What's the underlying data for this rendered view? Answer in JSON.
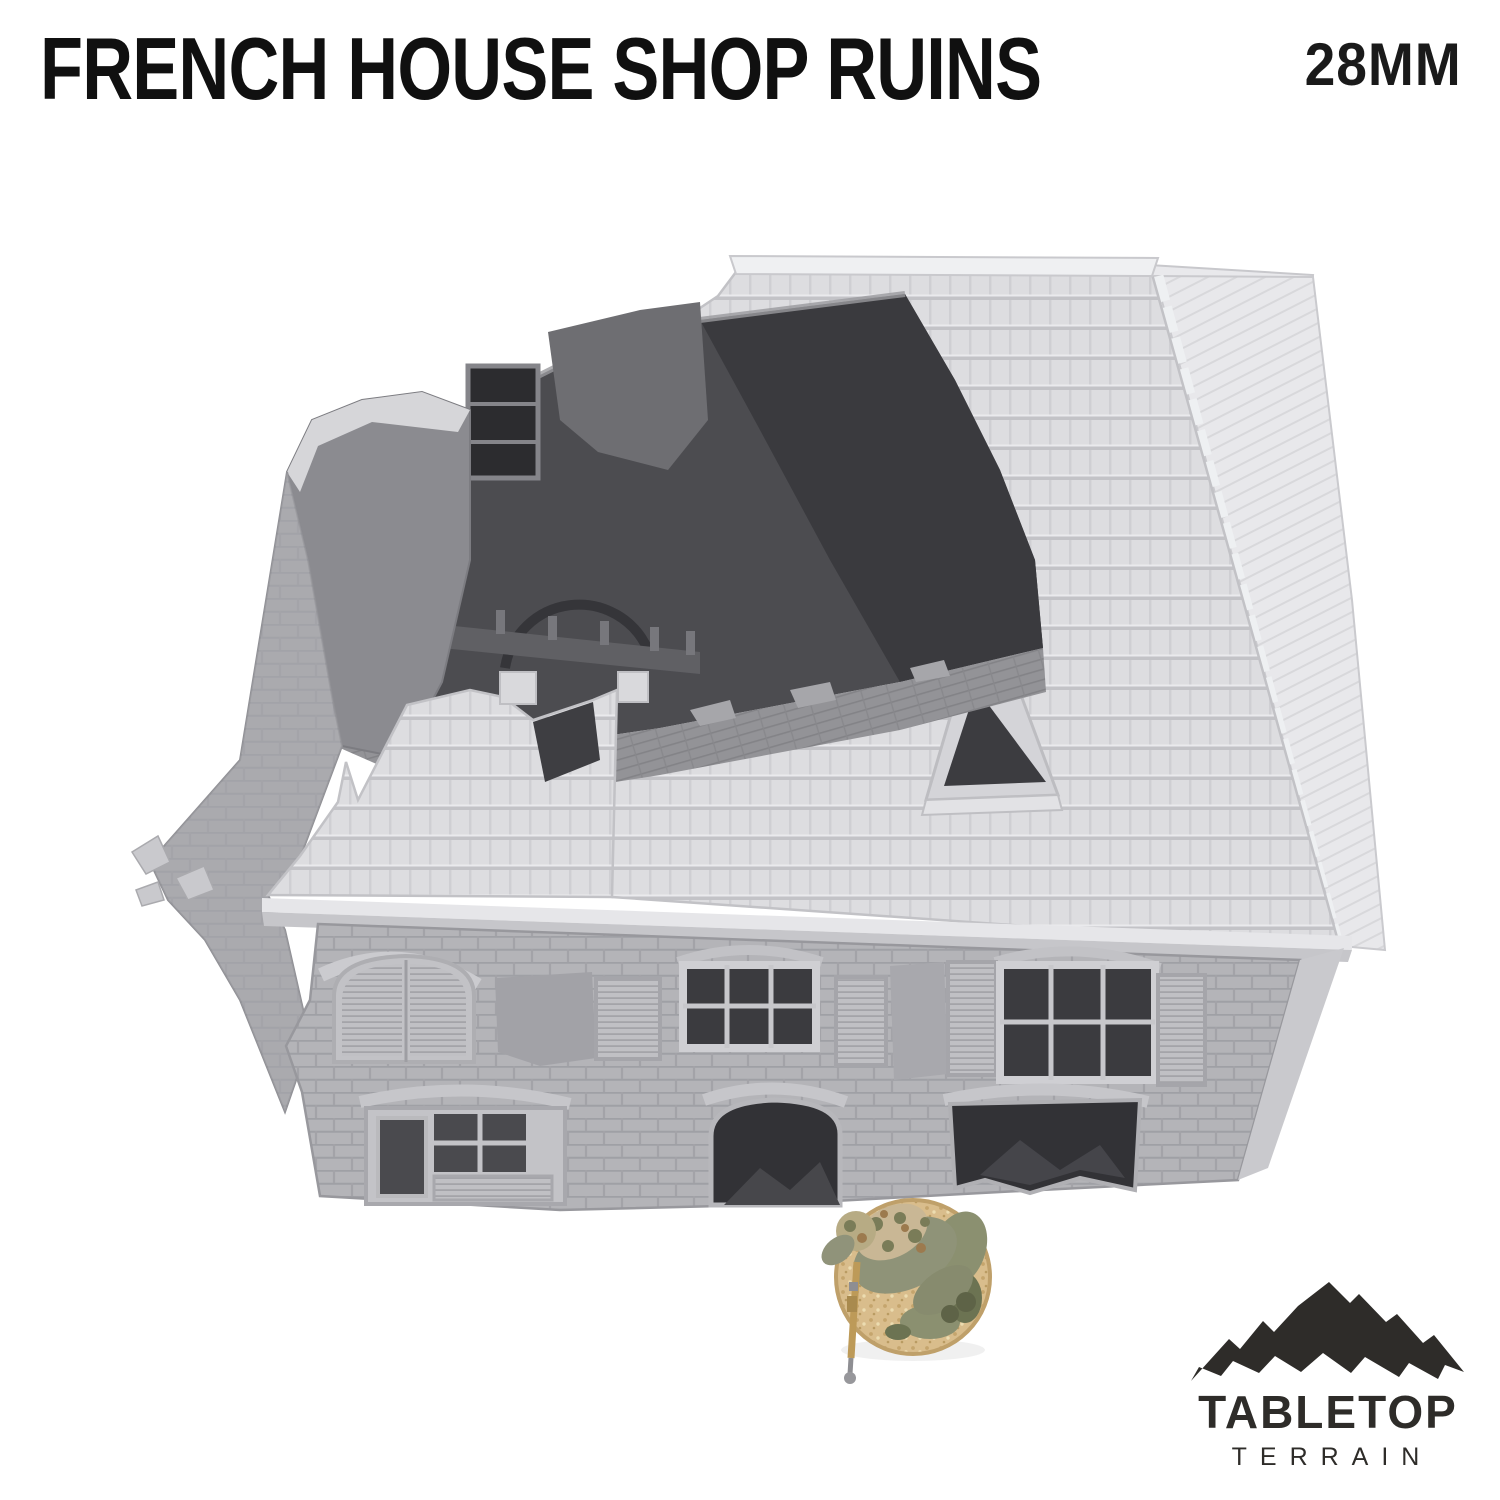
{
  "page": {
    "background": "#ffffff",
    "width": 1500,
    "height": 1500
  },
  "header": {
    "title": "FRENCH HOUSE SHOP RUINS",
    "title_color": "#101010",
    "scale_label": "28MM"
  },
  "product_photo": {
    "alt": "Unpainted grey 3D-printed French house shop ruins terrain model seen from above: damaged tiled hip roof with small dormer, collapsed upper storey exposing dark interior walls and floor, brick facade with shuttered and ruined windows, with a 28mm camouflaged soldier miniature on a round sand base for scale",
    "subject": "french-house-shop-ruins-model",
    "model_colors": {
      "roof_tile": "#dddde0",
      "roof_hip": "#e8e8eb",
      "ridge_cap": "#eff0f2",
      "brick_wall": "#b4b4b8",
      "cornice": "#e6e6e9",
      "interior_wall": "#4c4c50",
      "interior_shadow": "#3a3a3e",
      "interior_floor": "#939397",
      "window_dark": "#3b3b3f"
    },
    "miniature": {
      "desc": "prone camouflaged soldier miniature on round sand-textured base with rifle",
      "base_color": "#d9bd8c",
      "flock_color": "#8b9070",
      "camo_colors": [
        "#c9b795",
        "#7a7c58",
        "#9c7a4e"
      ],
      "cloak_color": "#8f9378",
      "rifle_color": "#bd9a58",
      "rifle_metal": "#8e8e92"
    }
  },
  "logo": {
    "icon": "mountain-range-icon",
    "line1": "TABLETOP",
    "line2": "TERRAIN",
    "color": "#2e2c29"
  }
}
